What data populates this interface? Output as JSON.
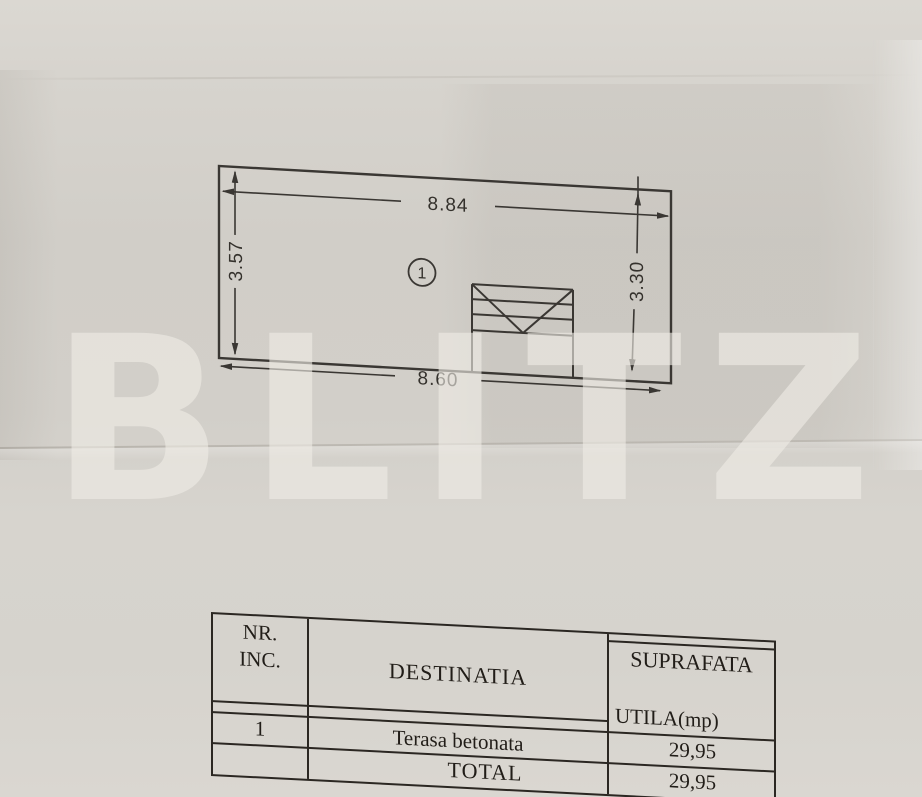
{
  "page": {
    "watermark_text": "BLITZ"
  },
  "floor_plan": {
    "room_number": "1",
    "dim_top": "8.84",
    "dim_left": "3.57",
    "dim_right": "3.30",
    "dim_bottom": "8.60"
  },
  "area_table": {
    "header": {
      "nr_line1": "NR.",
      "nr_line2": "INC.",
      "destinatia": "DESTINATIA",
      "suprafata_line1": "SUPRAFATA",
      "suprafata_line2": "UTILA(mp)"
    },
    "rows": [
      {
        "nr": "1",
        "destinatia": "Terasa betonata",
        "suprafata": "29,95"
      }
    ],
    "total": {
      "label": "TOTAL",
      "value": "29,95"
    }
  },
  "colors": {
    "paper": "#d5d2cc",
    "ink": "#3a3733",
    "table_ink": "#2b2722",
    "watermark": "#efece5"
  }
}
